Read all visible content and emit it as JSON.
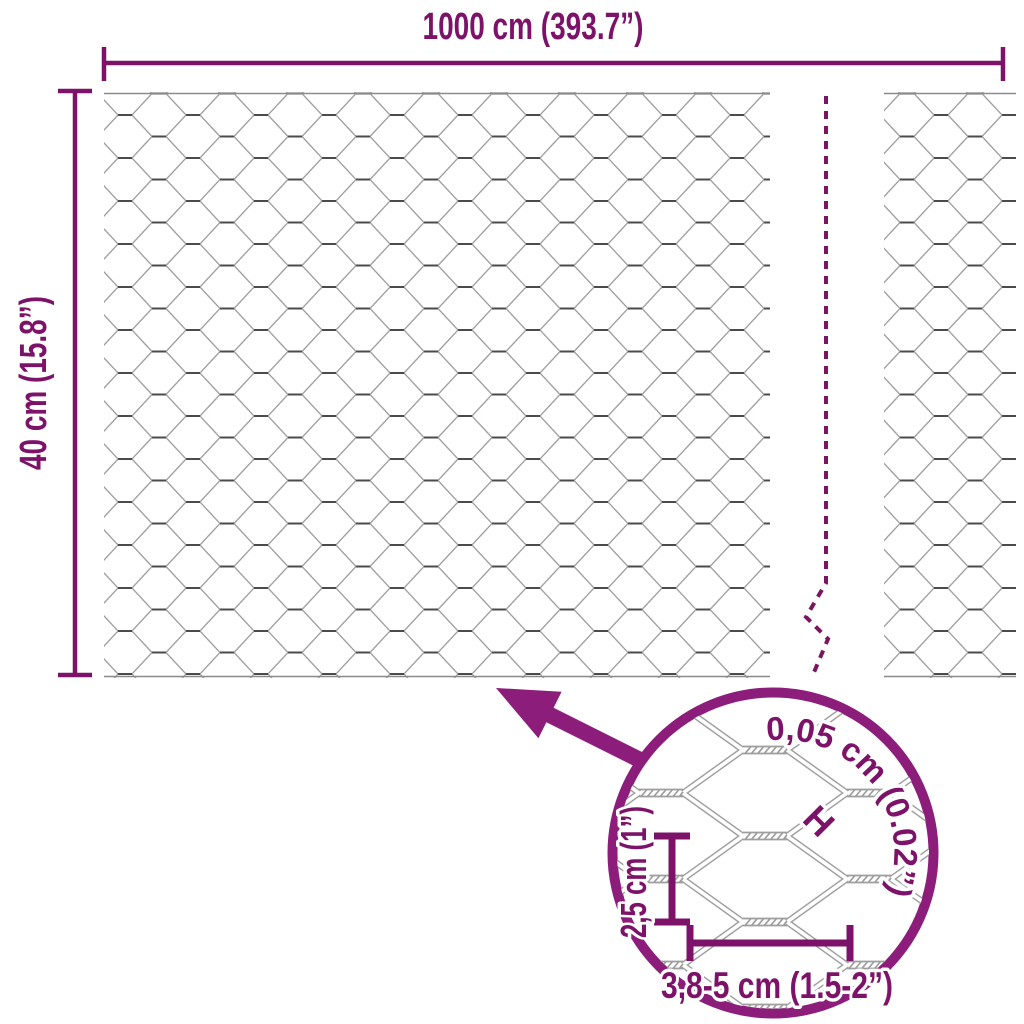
{
  "labels": {
    "total_width": "1000 cm (393.7”)",
    "total_height": "40 cm (15.8”)"
  },
  "detail": {
    "wire_thickness": "0,05 cm (0.02”)",
    "thickness_marker": "H",
    "cell_height": "2,5 cm (1”)",
    "cell_width": "3,8-5 cm (1.5-2”)"
  },
  "colors": {
    "dimension_accent": "#7d1368",
    "magnifier_accent": "#8c1d7a",
    "wire_gray": "#9e9e9e",
    "twist_dark": "#4b4b4b"
  }
}
